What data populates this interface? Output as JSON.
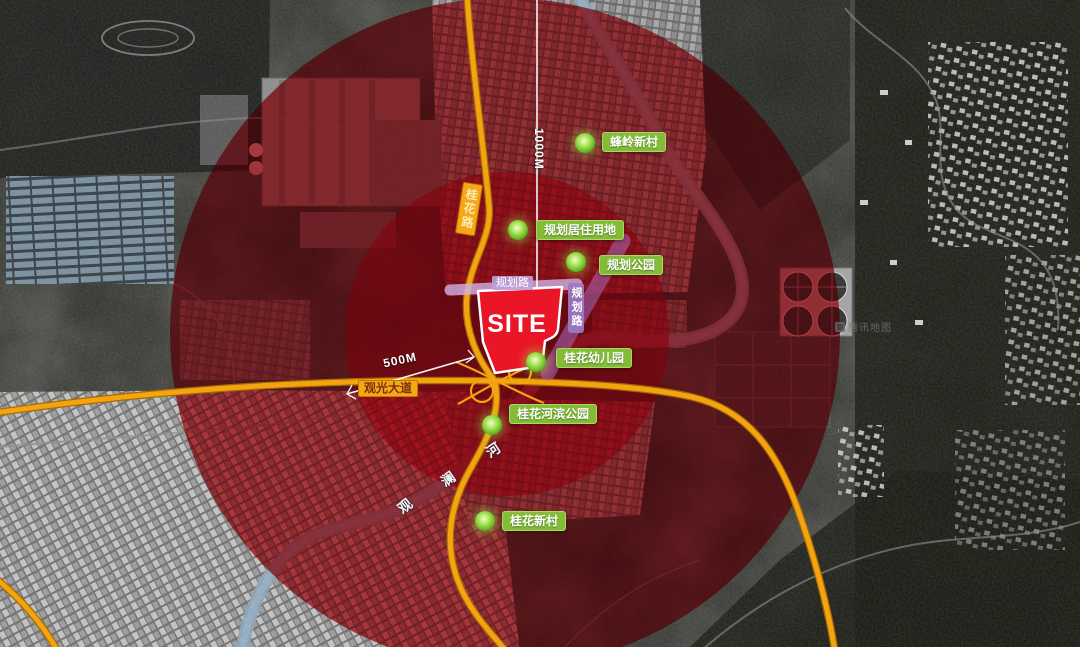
{
  "map": {
    "site": {
      "label": "SITE"
    },
    "distance_markers": {
      "inner": "500M",
      "outer": "1000M"
    },
    "poi_labels": [
      {
        "name": "fengling-new-village",
        "label": "蜂岭新村"
      },
      {
        "name": "planned-residential-land",
        "label": "规划居住用地"
      },
      {
        "name": "planned-park",
        "label": "规划公园"
      },
      {
        "name": "guihua-kindergarten",
        "label": "桂花幼儿园"
      },
      {
        "name": "guihua-riverside-park",
        "label": "桂花河滨公园"
      },
      {
        "name": "guihua-new-village",
        "label": "桂花新村"
      }
    ],
    "road_labels": {
      "avenue": "观光大道",
      "north_road": "桂花路"
    },
    "planned_road_labels": {
      "horizontal": "规划路",
      "vertical": "规划路"
    },
    "river": {
      "name": "观澜河",
      "chars": [
        "观",
        "澜",
        "河"
      ]
    },
    "watermark": "腾讯地图",
    "colors": {
      "highway_orange": "#f3a40e",
      "river_blue": "#8ba6bb",
      "poi_green": "#84bc38",
      "site_red": "#ea1526",
      "radius_red": "#c00a1e",
      "planned_road_purple": "#9c7ac4"
    }
  }
}
